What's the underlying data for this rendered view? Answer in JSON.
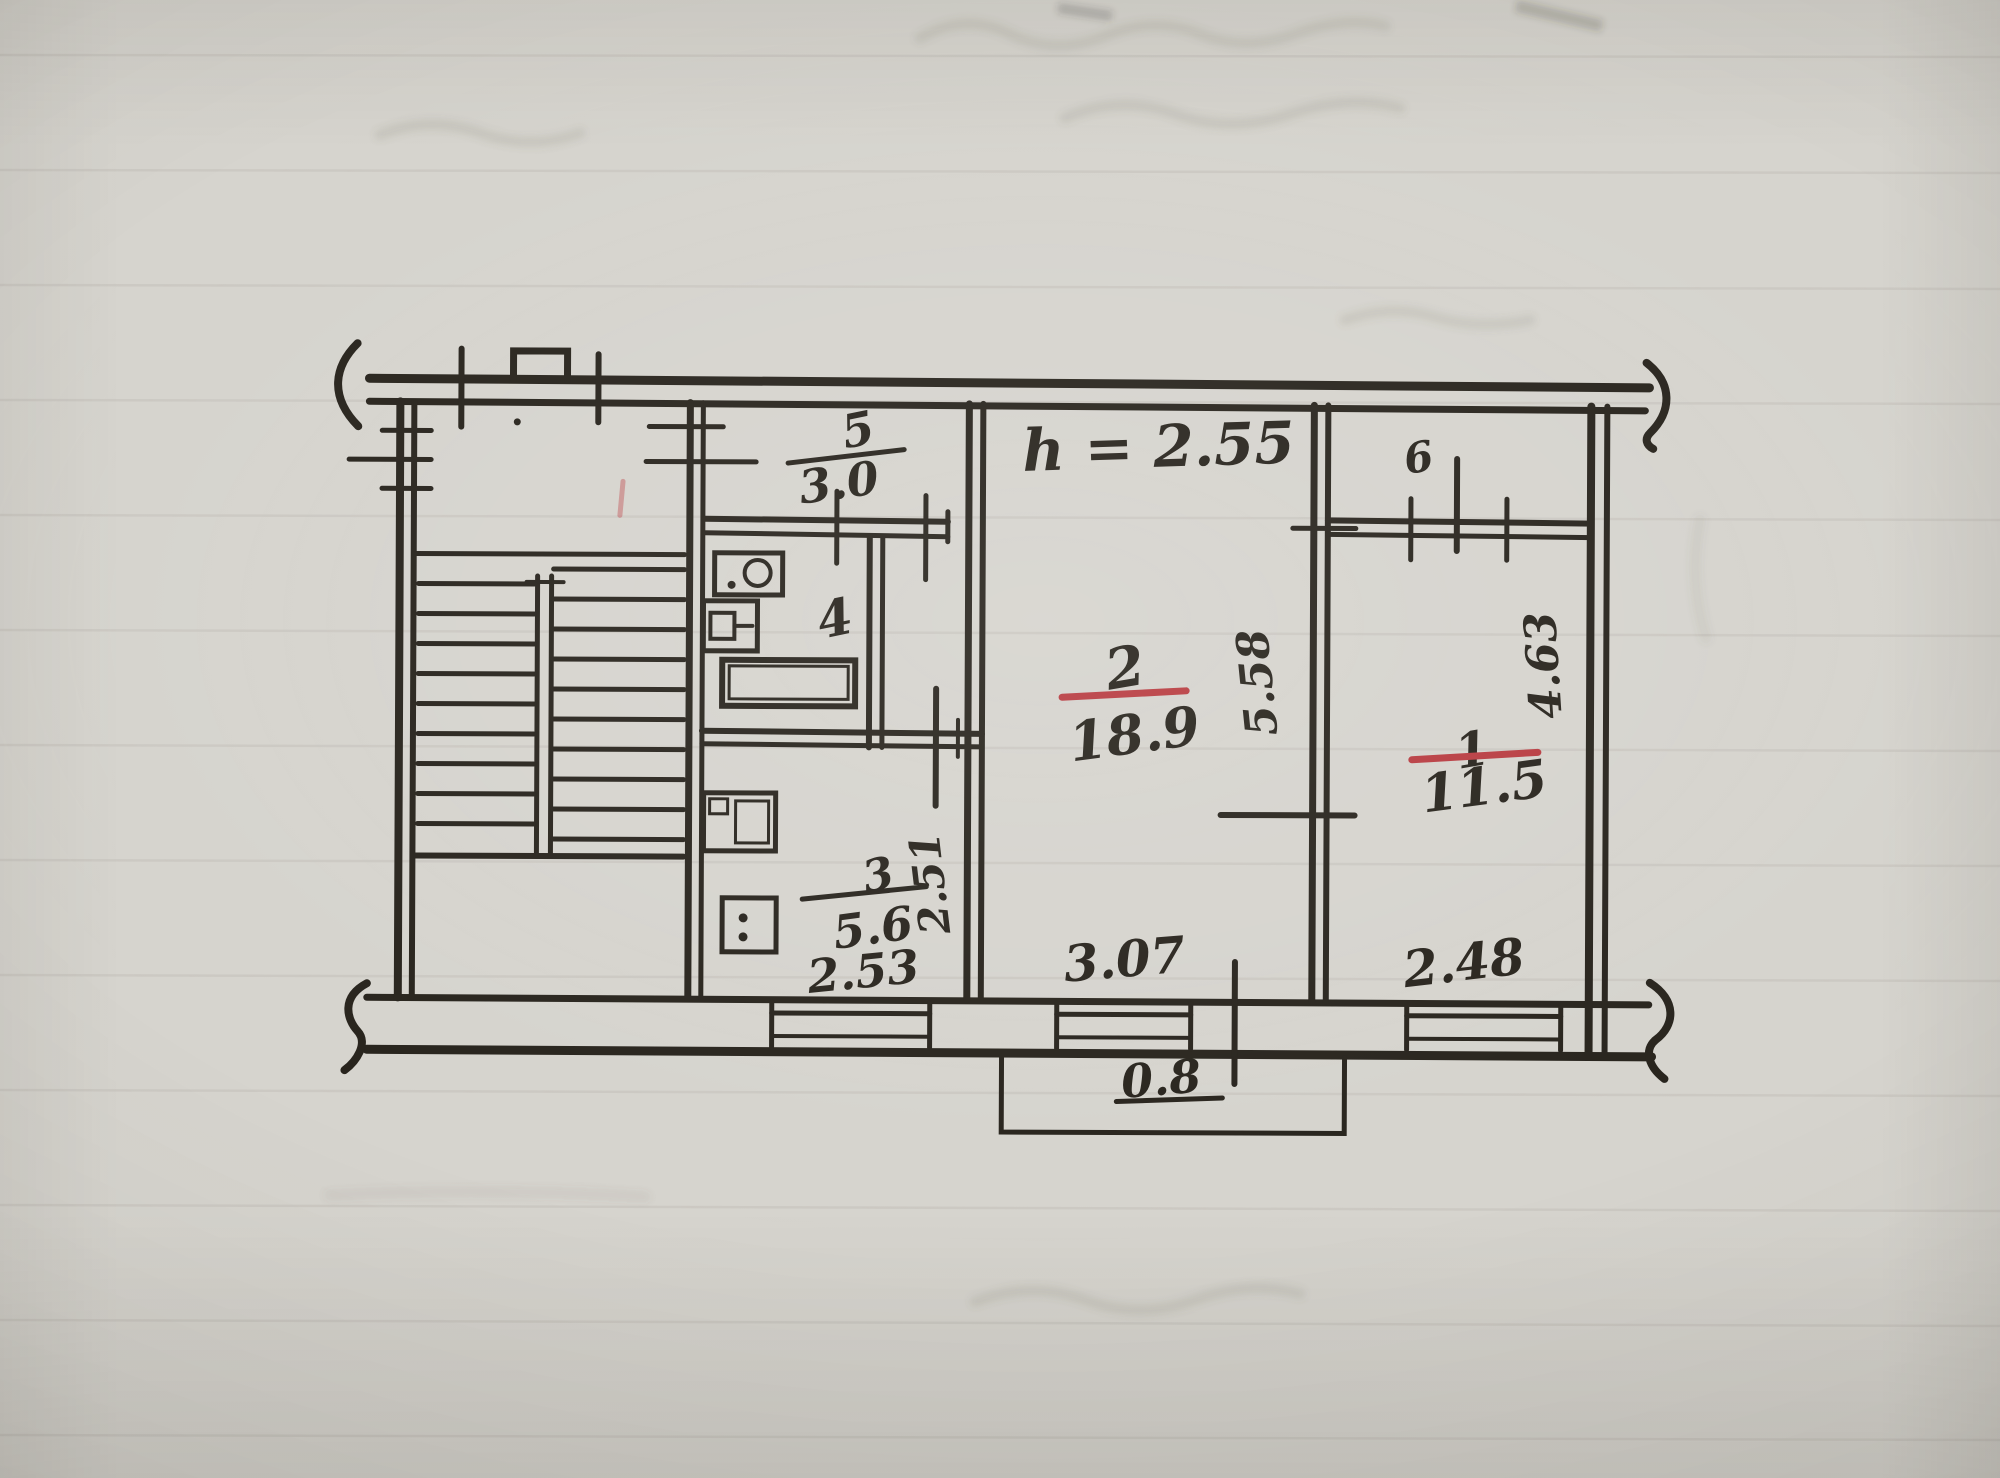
{
  "palette": {
    "paper": "#d6d4ce",
    "ink": "#27231c",
    "red_ink": "#b83b40"
  },
  "plan": {
    "height_note": "h = 2.55",
    "rooms": {
      "r1": {
        "number": "1",
        "area": "11.5"
      },
      "r2": {
        "number": "2",
        "area": "18.9"
      },
      "r3": {
        "number": "3",
        "area": "5.6"
      },
      "r4": {
        "number": "4"
      },
      "r5": {
        "number": "5",
        "area": "3.0"
      },
      "r6": {
        "number": "6"
      }
    },
    "dimensions": {
      "living_room_width": "3.07",
      "living_room_depth": "5.58",
      "bedroom_width": "2.48",
      "bedroom_depth": "4.63",
      "kitchen_width": "2.53",
      "kitchen_depth": "2.51",
      "porch_width": "0.8"
    }
  }
}
